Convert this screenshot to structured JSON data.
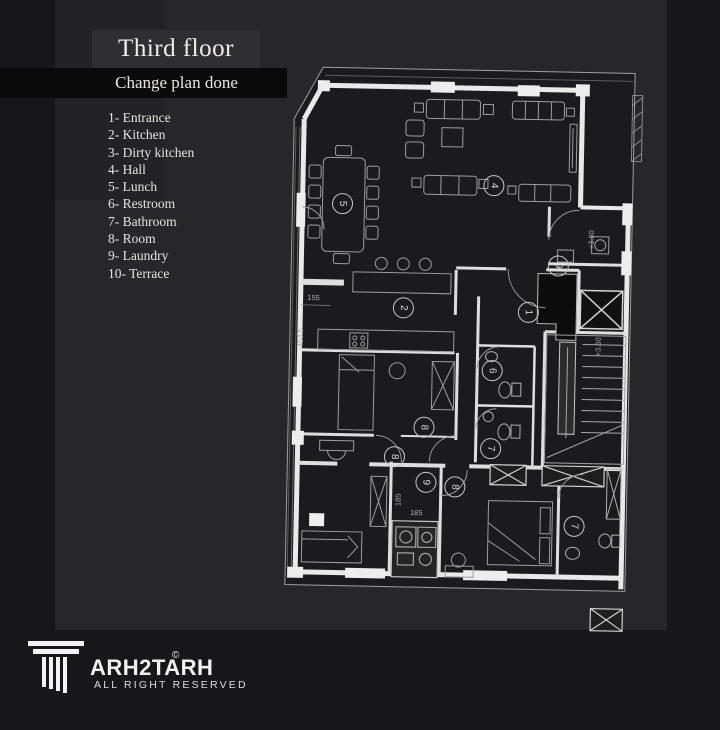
{
  "header": {
    "title": "Third floor",
    "subtitle": "Change plan done"
  },
  "legend": {
    "items": [
      "1- Entrance",
      "2- Kitchen",
      "3- Dirty kitchen",
      "4- Hall",
      "5- Lunch",
      "6- Restroom",
      "7- Bathroom",
      "8- Room",
      "9- Laundry",
      "10- Terrace"
    ]
  },
  "plan": {
    "room_labels": [
      "5",
      "4",
      "2",
      "9",
      "1",
      "6",
      "8",
      "8",
      "9",
      "8",
      "7",
      "7"
    ],
    "dimensions": {
      "w155": "155",
      "h4535": "453.5",
      "l185a": "185",
      "l185b": "185",
      "level_a": "+3.80",
      "level_b": "+3.80"
    }
  },
  "footer": {
    "brand": "ARH2TARH",
    "copyright": "©",
    "rights": "ALL RIGHT RESERVED"
  },
  "colors": {
    "background": "#17171a",
    "panel": "#27272a",
    "title_box": "#2f2f32",
    "ribbon": "#0a0a0b",
    "text": "#eae8e4",
    "wall": "#ececec",
    "plan_bg": "#1b1b1d"
  }
}
